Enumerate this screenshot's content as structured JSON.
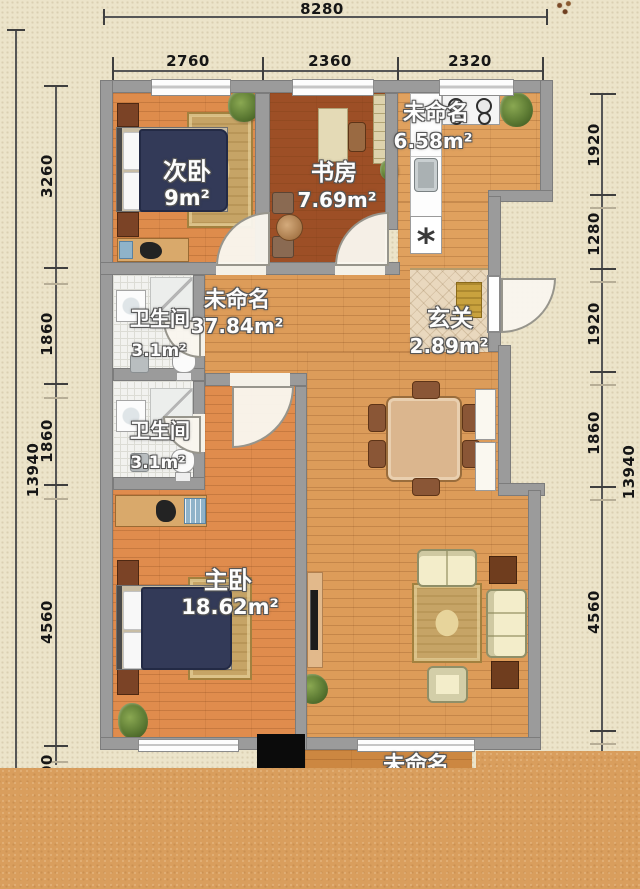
{
  "plan": {
    "dims_top": {
      "total": "8280",
      "segments": [
        "2760",
        "2360",
        "2320"
      ]
    },
    "dims_left": {
      "total": "13940",
      "segments": [
        "3260",
        "1860",
        "1860",
        "4560"
      ],
      "bottom_partial": "2400"
    },
    "dims_right": {
      "total": "13940",
      "segments": [
        "1920",
        "1280",
        "1920",
        "1860",
        "4560"
      ]
    },
    "rooms": {
      "secondary_bedroom": {
        "name": "次卧",
        "area": "9m²"
      },
      "study": {
        "name": "书房",
        "area": "7.69m²"
      },
      "kitchen": {
        "name": "未命名",
        "area": "6.58m²",
        "fridge_symbol": "*"
      },
      "bathroom_upper": {
        "name": "卫生间",
        "area": "3.1m²"
      },
      "bathroom_lower": {
        "name": "卫生间",
        "area": "3.1m²"
      },
      "living": {
        "name": "未命名",
        "area": "37.84m²"
      },
      "entry": {
        "name": "玄关",
        "area": "2.89m²"
      },
      "master_bedroom": {
        "name": "主卧",
        "area": "18.62m²"
      },
      "bottom_room": {
        "name": "未命名"
      }
    },
    "colors": {
      "background": "#ece4ca",
      "wall": "#9b9b9b",
      "wood_light": "#dd9c59",
      "wood_dark": "#9d4f26",
      "bed_navy": "#333a58",
      "rug_gold": "#c6a466",
      "cutoff_overlay": "#d99e5d"
    }
  }
}
